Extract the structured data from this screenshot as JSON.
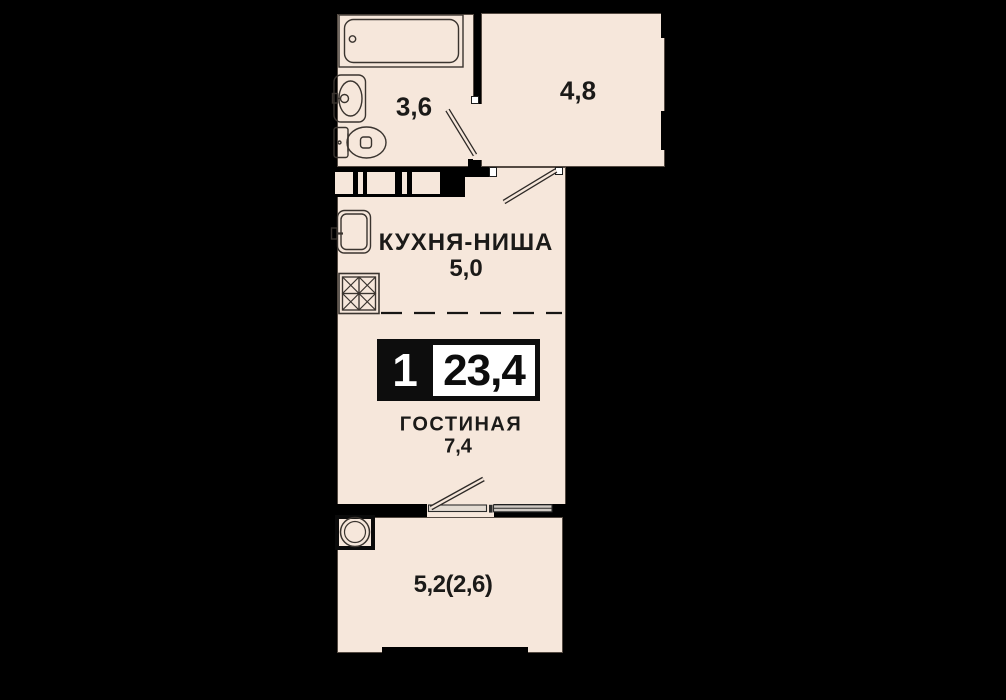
{
  "plan": {
    "type": "apartment-floor-plan",
    "unit_badge": {
      "rooms_count": "1",
      "total_area": "23,4"
    },
    "rooms": {
      "bathroom": {
        "area": "3,6"
      },
      "hallway": {
        "area": "4,8"
      },
      "kitchen": {
        "name": "КУХНЯ-НИША",
        "area": "5,0"
      },
      "living": {
        "name": "ГОСТИНАЯ",
        "area": "7,4"
      },
      "balcony": {
        "area": "5,2(2,6)"
      }
    },
    "fixtures": [
      "bathtub-icon",
      "washbasin-icon",
      "toilet-icon",
      "kitchen-sink-icon",
      "cooktop-icon",
      "ac-unit-icon",
      "bathroom-door-swing-icon",
      "kitchen-door-swing-icon",
      "balcony-door-icon",
      "balcony-window-icon",
      "duct-opening-icon",
      "kitchen-zone-dashed-divider"
    ],
    "colors": {
      "background": "#000000",
      "floor": "#f6e7db",
      "wall": "#000000",
      "outline": "#42392f",
      "badge_background": "#0d0d0d",
      "badge_panel": "#ffffff",
      "text": "#1b1a18"
    }
  }
}
